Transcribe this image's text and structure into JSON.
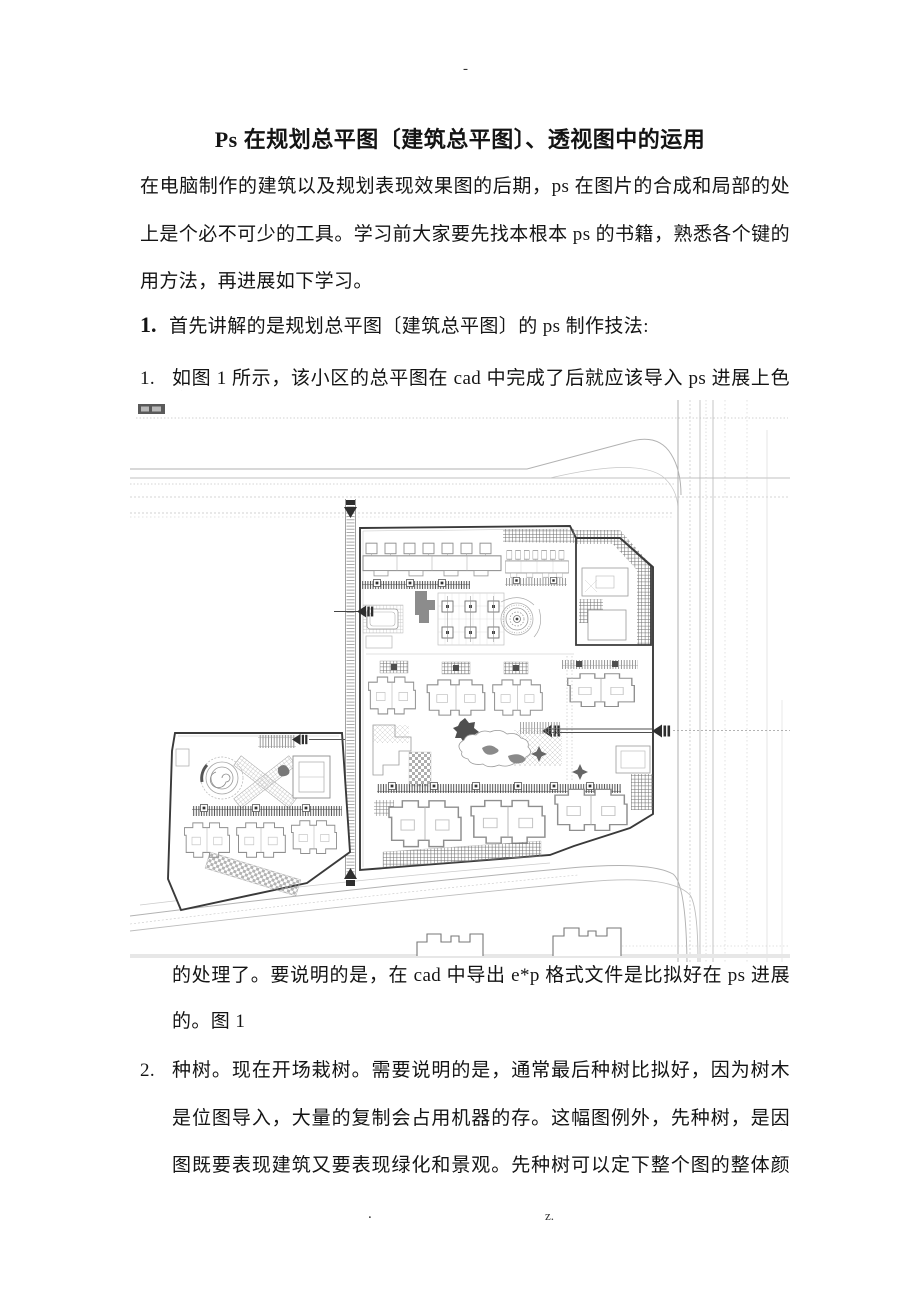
{
  "page": {
    "header_mark": "-",
    "footer_left_mark": ".",
    "footer_right_mark": "z."
  },
  "document": {
    "title": "Ps 在规划总平图〔建筑总平图〕、透视图中的运用",
    "intro": {
      "lines": [
        "在电脑制作的建筑以及规划表现效果图的后期，ps 在图片的合成和局部的处理",
        "上是个必不可少的工具。学习前大家要先找本根本 ps 的书籍，熟悉各个键的使",
        "用方法，再进展如下学习。"
      ]
    },
    "section1": {
      "number": "1.",
      "heading": "首先讲解的是规划总平图〔建筑总平图〕的 ps 制作技法:"
    },
    "step1": {
      "number": "1.",
      "line1": "如图 1 所示，该小区的总平图在 cad 中完成了后就应该导入 ps 进展上色方面",
      "continuation": [
        "的处理了。要说明的是，在 cad 中导出 e*p 格式文件是比拟好在 ps 进展上色",
        "的。图 1"
      ]
    },
    "step2": {
      "number": "2.",
      "lines": [
        "种树。现在开场栽树。需要说明的是，通常最后种树比拟好，因为树木通常",
        "是位图导入，大量的复制会占用机器的存。这幅图例外，先种树，是因为这",
        "图既要表现建筑又要表现绿化和景观。先种树可以定下整个图的整体颜色倾"
      ]
    },
    "figure1": {
      "caption_ref": "图 1",
      "colors": {
        "site_boundary": "#3a3a3a",
        "road_lines": "#b9b9b9",
        "hatch_dark": "#4e4e4e",
        "building_outline": "#8f8f8f"
      }
    }
  }
}
